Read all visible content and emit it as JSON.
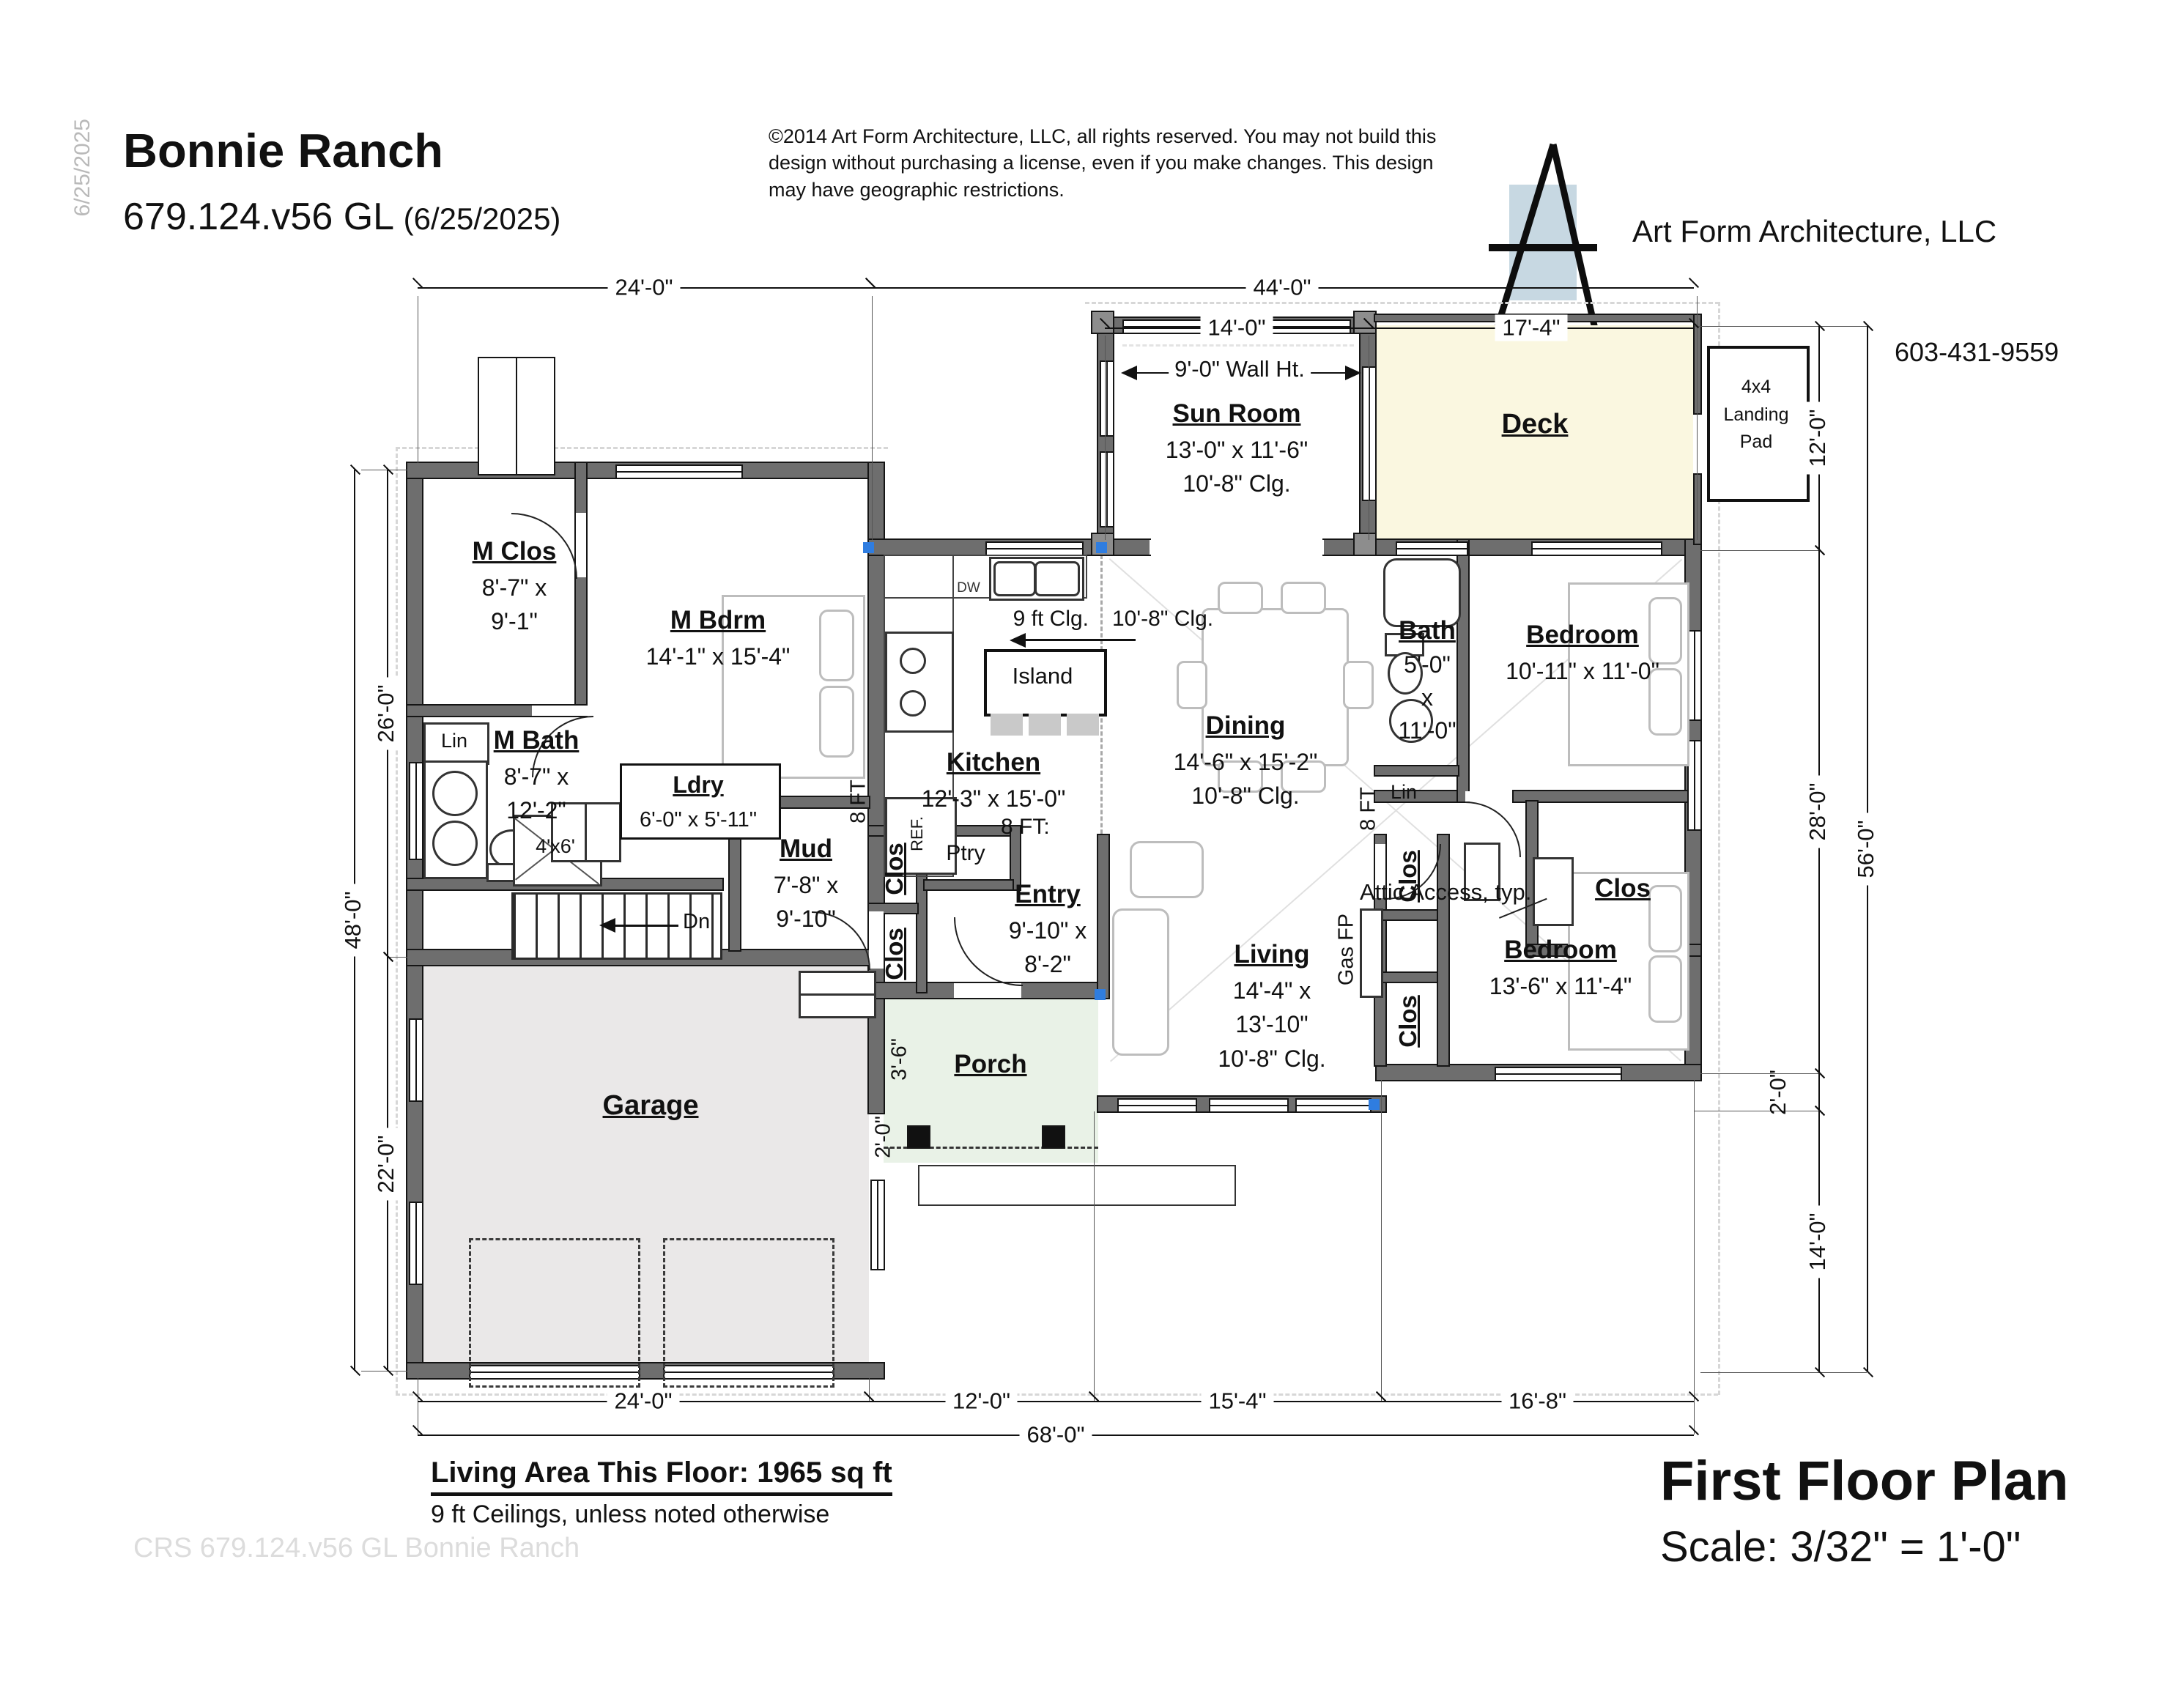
{
  "header": {
    "side_date": "6/25/2025",
    "title": "Bonnie Ranch",
    "plan_number": "679.124.v56 GL",
    "plan_date": "(6/25/2025)",
    "copyright": "©2014 Art Form Architecture, LLC, all rights reserved. You may not build this design without purchasing a license, even if you make changes. This design may have geographic restrictions.",
    "company": "Art Form Architecture, LLC",
    "phone": "603-431-9559"
  },
  "plan": {
    "rooms": {
      "sun_room": {
        "name": "Sun Room",
        "size": "13'-0\" x 11'-6\"",
        "clg": "10'-8\" Clg."
      },
      "deck": {
        "name": "Deck"
      },
      "landing_pad": {
        "line1": "4x4",
        "line2": "Landing",
        "line3": "Pad"
      },
      "m_clos": {
        "name": "M Clos",
        "size1": "8'-7\" x",
        "size2": "9'-1\""
      },
      "m_bdrm": {
        "name": "M Bdrm",
        "size": "14'-1\" x 15'-4\""
      },
      "m_bath": {
        "name": "M Bath",
        "size1": "8'-7\" x",
        "size2": "12'-2\""
      },
      "lin_master": "Lin",
      "ldry": {
        "name": "Ldry",
        "size": "6'-0\" x 5'-11\""
      },
      "kitchen": {
        "name": "Kitchen",
        "size": "12'-3\" x 15'-0\""
      },
      "island": "Island",
      "dining": {
        "name": "Dining",
        "size": "14'-6\" x 15'-2\"",
        "clg": "10'-8\" Clg."
      },
      "bath": {
        "name": "Bath",
        "size1": "5'-0\"",
        "size2": "x",
        "size3": "11'-0\""
      },
      "lin_hall": "Lin",
      "bedroom1": {
        "name": "Bedroom",
        "size": "10'-11\" x 11'-0\""
      },
      "clos_bedroom1": "Clos",
      "mud": {
        "name": "Mud",
        "size1": "7'-8\" x",
        "size2": "9'-10\""
      },
      "clos_mud_upper": "Clos",
      "clos_mud_lower": "Clos",
      "ptry": "Ptry",
      "entry": {
        "name": "Entry",
        "size1": "9'-10\" x",
        "size2": "8'-2\""
      },
      "porch": {
        "name": "Porch"
      },
      "living": {
        "name": "Living",
        "size1": "14'-4\" x",
        "size2": "13'-10\"",
        "clg": "10'-8\" Clg."
      },
      "gas_fp": "Gas FP",
      "clos_living_upper": "Clos",
      "clos_living_lower": "Clos",
      "bedroom2": {
        "name": "Bedroom",
        "size": "13'-6\" x 11'-4\""
      },
      "garage": {
        "name": "Garage"
      },
      "shower": "4'x6'",
      "dishwasher": "DW",
      "refrigerator": "REF.",
      "stairs_down": "Dn"
    },
    "annotations": {
      "wall_height": "9'-0\" Wall Ht.",
      "ceiling_9": "9 ft Clg.",
      "ceiling_108": "10'-8\" Clg.",
      "eight_ft_colon": "8 FT:",
      "eight_ft": "8 FT",
      "attic": "Attic Access, typ."
    },
    "dims": {
      "top_garage": "24'-0\"",
      "top_main": "44'-0\"",
      "top_sun": "14'-0\"",
      "top_deck": "17'-4\"",
      "right_deck": "12'-0\"",
      "right_main": "28'-0\"",
      "right_offset": "2'-0\"",
      "right_front": "14'-0\"",
      "right_total": "56'-0\"",
      "left_master": "26'-0\"",
      "left_garage": "22'-0\"",
      "left_total": "48'-0\"",
      "bottom_garage": "24'-0\"",
      "bottom_porch": "12'-0\"",
      "bottom_living": "15'-4\"",
      "bottom_bedroom": "16'-8\"",
      "bottom_total": "68'-0\"",
      "porch_depth": "3'-6\"",
      "porch_overhang": "2'-0\""
    }
  },
  "footer": {
    "living_area": "Living Area This Floor: 1965 sq ft",
    "ceiling_note": "9 ft Ceilings, unless noted otherwise",
    "watermark": "CRS 679.124.v56 GL Bonnie Ranch",
    "plan_title": "First Floor Plan",
    "scale": "Scale: 3/32\" = 1'-0\""
  }
}
